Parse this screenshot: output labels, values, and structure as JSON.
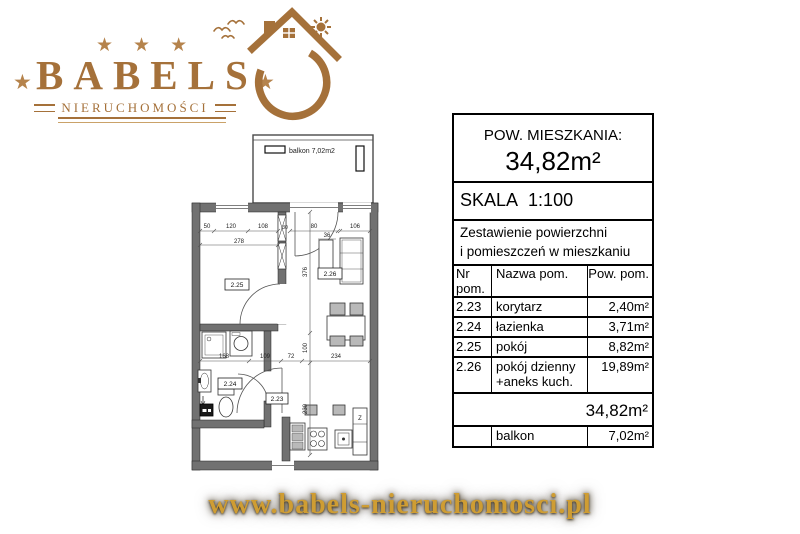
{
  "logo": {
    "brand": "BABELS",
    "subtitle": "NIERUCHOMOŚCI",
    "star": "★",
    "accent_color": "#a5713a"
  },
  "footer": {
    "url": "www.babels-nieruchomosci.pl",
    "gold_color": "#cf9d33"
  },
  "panel": {
    "area_label": "POW. MIESZKANIA:",
    "area_value": "34,82m²",
    "scale": "SKALA 1:100",
    "summary1": "Zestawienie powierzchni",
    "summary2": "i pomieszczeń w mieszkaniu",
    "col_nr": "Nr pom.",
    "col_name": "Nazwa pom.",
    "col_area": "Pow. pom.",
    "rows": [
      {
        "nr": "2.23",
        "name": "korytarz",
        "area": "2,40m²"
      },
      {
        "nr": "2.24",
        "name": "łazienka",
        "area": "3,71m²"
      },
      {
        "nr": "2.25",
        "name": "pokój",
        "area": "8,82m²"
      },
      {
        "nr": "2.26",
        "name": "pokój dzienny",
        "name2": "+aneks kuch.",
        "area": "19,89m²"
      }
    ],
    "total": "34,82m²",
    "balcony_row": {
      "name": "balkon",
      "area": "7,02m²"
    }
  },
  "floorplan": {
    "balcony_label": "balkon 7,02m2",
    "rooms": {
      "r225": "2.25",
      "r226": "2.26",
      "r224": "2.24",
      "r223": "2.23"
    },
    "dims": {
      "top1": "50",
      "top2": "120",
      "top3": "108",
      "top_total": "278",
      "duct": "30",
      "balcony_door": "80",
      "window_right": "106",
      "wardrobe": "36",
      "mid1": "168",
      "mid2": "109",
      "mid3": "72",
      "mid4": "234",
      "vert1": "376",
      "vert2": "100",
      "vert3": "230"
    },
    "fridge": "Z"
  }
}
